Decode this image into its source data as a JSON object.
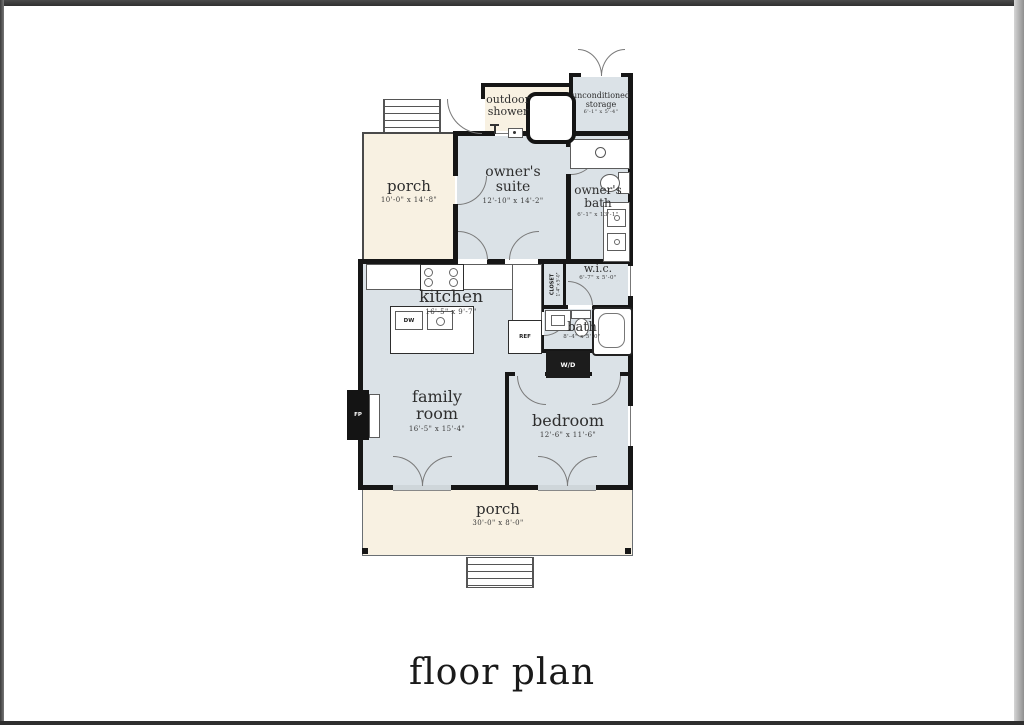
{
  "title": "floor plan",
  "colors": {
    "wall": "#161616",
    "room_fill": "#dbe2e7",
    "porch_fill": "#f8f1e2",
    "page": "#ffffff"
  },
  "rooms": {
    "porch_upper": {
      "name": "porch",
      "dim": "10'-0\" x 14'-8\""
    },
    "outdoor_shower": {
      "name_line1": "outdoor",
      "name_line2": "shower"
    },
    "storage": {
      "name_line1": "unconditioned",
      "name_line2": "storage",
      "dim": "6'-1\" x 5'-4\""
    },
    "owners_suite": {
      "name_line1": "owner's",
      "name_line2": "suite",
      "dim": "12'-10\" x 14'-2\""
    },
    "owners_bath": {
      "name_line1": "owner's",
      "name_line2": "bath",
      "dim": "6'-1\" x 13'-1\""
    },
    "wic": {
      "name": "w.i.c.",
      "dim": "6'-7\" x 5'-0\""
    },
    "closet": {
      "name": "CLOSET",
      "dim": "1'-4\" x 5'-0\""
    },
    "kitchen": {
      "name": "kitchen",
      "dim": "16'-5\" x 9'-7\""
    },
    "bath": {
      "name": "bath",
      "dim": "8'-4\" x 5'-0\""
    },
    "family_room": {
      "name_line1": "family",
      "name_line2": "room",
      "dim": "16'-5\" x 15'-4\""
    },
    "bedroom": {
      "name": "bedroom",
      "dim": "12'-6\" x 11'-6\""
    },
    "porch_lower": {
      "name": "porch",
      "dim": "30'-0\" x 8'-0\""
    }
  },
  "appliances": {
    "dishwasher": "DW",
    "refrigerator": "REF",
    "washer_dryer": "W/D",
    "fireplace": "FP"
  }
}
